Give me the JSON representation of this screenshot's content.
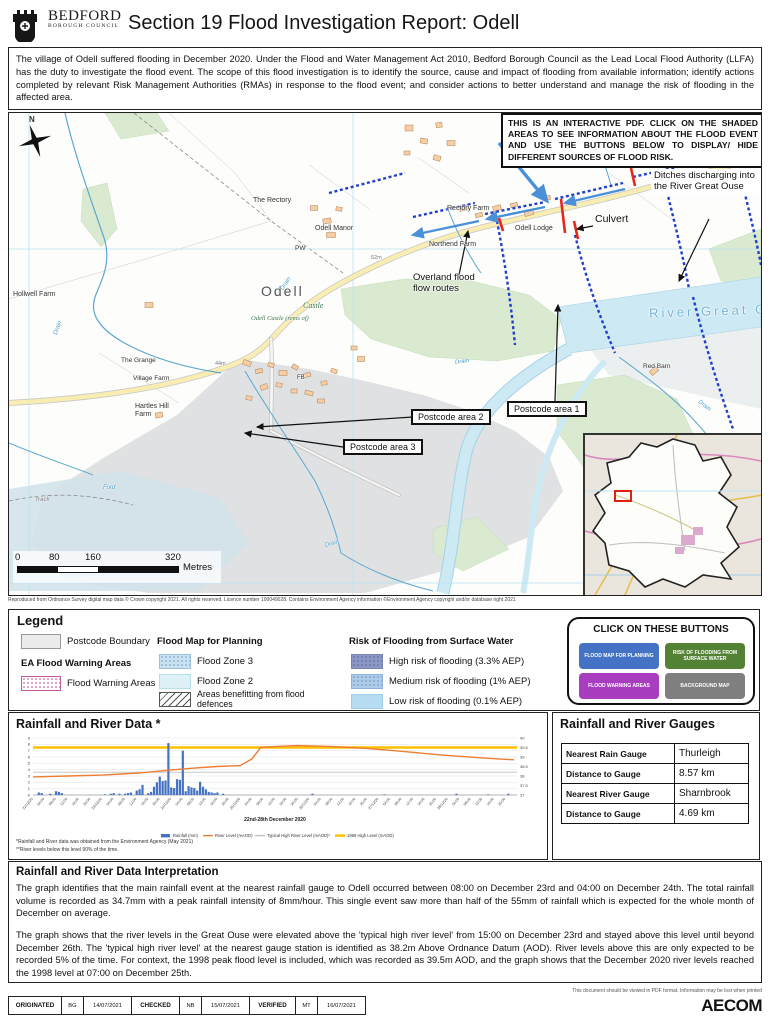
{
  "header": {
    "council_name": "BEDFORD",
    "council_sub": "BOROUGH COUNCIL",
    "title": "Section 19 Flood Investigation Report: Odell"
  },
  "intro": {
    "text": "The village of Odell suffered flooding in December 2020. Under the Flood and Water Management Act 2010, Bedford Borough Council as the Lead Local Flood Authority (LLFA) has the duty to investigate the flood event. The scope of this flood investigation is to identify the source, cause and impact of flooding from available information; identify actions completed by relevant Risk Management Authorities (RMAs) in response to the flood event; and consider actions to better understand and manage the risk of flooding in the affected area."
  },
  "map": {
    "notice": "THIS IS AN INTERACTIVE PDF. CLICK ON THE SHADED AREAS TO SEE INFORMATION ABOUT THE FLOOD EVENT AND USE THE BUTTONS BELOW TO DISPLAY/ HIDE DIFFERENT SOURCES OF FLOOD RISK.",
    "annotations": {
      "ditches": "Ditches discharging into the River Great Ouse",
      "culvert": "Culvert",
      "overland": "Overland flood flow routes",
      "postcode1": "Postcode area 1",
      "postcode2": "Postcode area 2",
      "postcode3": "Postcode area 3"
    },
    "labels": {
      "north": "N",
      "odell": "Odell",
      "river": "River Great Ouse",
      "rectory_farm": "Rectory Farm",
      "northend_farm": "Northend Farm",
      "odell_lodge": "Odell Lodge",
      "the_rectory": "The Rectory",
      "odell_manor": "Odell Manor",
      "pw": "PW",
      "castle": "Castle",
      "odell_castle": "Odell Castle (rems of)",
      "hollwell_farm": "Hollwell Farm",
      "hartles_hill_farm": "Hartles Hill Farm",
      "the_grange": "The Grange",
      "village_farm": "Village Farm",
      "red_barn": "Red Barn",
      "drain": "Drain",
      "track": "Track",
      "ford": "Ford",
      "fb": "FB",
      "spot_52": "52m",
      "spot_49": "49m",
      "spot_44": "44m"
    },
    "scalebar": {
      "ticks": [
        "0",
        "80",
        "160",
        "320"
      ],
      "unit": "Metres"
    },
    "attribution": "Reproduced from Ordnance Survey digital map data © Crown copyright 2021. All rights reserved. Licence number 100049028. Contains Environment Agency information ©Environment Agency copyright and/or database right 2021"
  },
  "legend": {
    "title": "Legend",
    "postcode_boundary": "Postcode Boundary",
    "ea_heading": "EA Flood Warning Areas",
    "flood_warning": "Flood Warning Areas",
    "planning_heading": "Flood Map for Planning",
    "zone3": "Flood Zone 3",
    "zone2": "Flood Zone 2",
    "defences": "Areas benefitting from flood defences",
    "surface_heading": "Risk of Flooding from Surface Water",
    "high": "High risk of flooding (3.3% AEP)",
    "medium": "Medium risk of flooding (1% AEP)",
    "low": "Low risk of flooding (0.1% AEP)",
    "buttons": {
      "title": "CLICK ON THESE BUTTONS",
      "items": [
        {
          "label": "FLOOD MAP FOR PLANNING",
          "color": "#4472C4"
        },
        {
          "label": "RISK OF FLOODING FROM SURFACE WATER",
          "color": "#548235"
        },
        {
          "label": "FLOOD WARNING AREAS",
          "color": "#A83DC0"
        },
        {
          "label": "BACKGROUND MAP",
          "color": "#7F7F7F"
        }
      ]
    }
  },
  "rainfall_panel": {
    "title": "Rainfall and River Data *",
    "footnote1": "*Rainfall and River data was obtained from the Environment Agency (May 2021)",
    "footnote2": "**River levels below this level 90% of the time."
  },
  "gauges": {
    "title": "Rainfall and River Gauges",
    "rows": [
      {
        "label": "Nearest Rain Gauge",
        "value": "Thurleigh"
      },
      {
        "label": "Distance to Gauge",
        "value": "8.57 km"
      },
      {
        "label": "Nearest River Gauge",
        "value": "Sharnbrook"
      },
      {
        "label": "Distance to Gauge",
        "value": "4.69 km"
      }
    ]
  },
  "interpretation": {
    "title": "Rainfall and River Data Interpretation",
    "para1": "The graph identifies that the main rainfall event at the nearest rainfall gauge to Odell occurred between 08:00 on December 23rd and 04:00 on December 24th. The total rainfall volume is recorded as 34.7mm with a peak rainfall intensity of 8mm/hour. This single event saw more than half of the 55mm of rainfall which is expected for the whole month of December on average.",
    "para2": "The graph shows that the river levels in the Great Ouse were elevated above the 'typical high river level' from 15:00 on December 23rd and stayed above this level until beyond December 26th. The 'typical high river level' at the nearest gauge station is identified as 38.2m Above Ordnance Datum (AOD). River levels above this are only expected to be recorded 5% of the time. For context, the 1998 peak flood level is included, which was recorded as 39.5m AOD, and the graph shows that the December 2020 river levels reached the 1998 level at 07:00 on December 25th."
  },
  "footer": {
    "note": "This document should be viewed in PDF format. Information may be lost when printed",
    "cells": [
      {
        "label": "ORIGINATED",
        "initials": "BG",
        "date": "14/07/2021"
      },
      {
        "label": "CHECKED",
        "initials": "NB",
        "date": "15/07/2021"
      },
      {
        "label": "VERIFIED",
        "initials": "MT",
        "date": "16/07/2021"
      }
    ],
    "brand": "AECOM"
  },
  "chart_data": {
    "type": "bar",
    "title": "Rainfall and River Data *",
    "x_title": "22nd-28th December 2020",
    "hours_span": 168,
    "hours_per_tick": 4,
    "x_tick_labels": [
      "22/12/20",
      "04:00",
      "08:00",
      "12:00",
      "16:00",
      "20:00",
      "23/12/20",
      "04:00",
      "08:00",
      "12:00",
      "16:00",
      "20:00",
      "24/12/20",
      "04:00",
      "08:00",
      "12:00",
      "16:00",
      "20:00",
      "25/12/20",
      "04:00",
      "08:00",
      "12:00",
      "16:00",
      "20:00",
      "26/12/20",
      "04:00",
      "08:00",
      "12:00",
      "16:00",
      "20:00",
      "27/12/20",
      "04:00",
      "08:00",
      "12:00",
      "16:00",
      "20:00",
      "28/12/20",
      "04:00",
      "08:00",
      "12:00",
      "16:00",
      "20:00"
    ],
    "left_axis": {
      "label": "Rainfall (mm)",
      "min": 0,
      "max": 9,
      "step": 1
    },
    "right_axis": {
      "label": "River Level (mAOD)",
      "min": 37,
      "max": 40,
      "step": 0.5
    },
    "rainfall": {
      "name": "Rainfall (mm)",
      "color": "#4472C4",
      "points": [
        [
          2,
          0.4
        ],
        [
          3,
          0.3
        ],
        [
          6,
          0.2
        ],
        [
          8,
          0.6
        ],
        [
          9,
          0.5
        ],
        [
          10,
          0.3
        ],
        [
          25,
          0.1
        ],
        [
          27,
          0.2
        ],
        [
          28,
          0.3
        ],
        [
          30,
          0.2
        ],
        [
          32,
          0.2
        ],
        [
          33,
          0.3
        ],
        [
          34,
          0.4
        ],
        [
          36,
          0.7
        ],
        [
          37,
          0.9
        ],
        [
          38,
          1.6
        ],
        [
          40,
          0.3
        ],
        [
          41,
          0.5
        ],
        [
          42,
          1.3
        ],
        [
          43,
          2.0
        ],
        [
          44,
          2.9
        ],
        [
          45,
          2.2
        ],
        [
          46,
          2.3
        ],
        [
          47,
          8.2
        ],
        [
          48,
          1.2
        ],
        [
          49,
          1.1
        ],
        [
          50,
          2.5
        ],
        [
          51,
          2.4
        ],
        [
          52,
          7.0
        ],
        [
          53,
          0.6
        ],
        [
          54,
          1.4
        ],
        [
          55,
          1.2
        ],
        [
          56,
          1.1
        ],
        [
          57,
          0.7
        ],
        [
          58,
          2.1
        ],
        [
          59,
          1.3
        ],
        [
          60,
          0.9
        ],
        [
          61,
          0.5
        ],
        [
          62,
          0.4
        ],
        [
          63,
          0.3
        ],
        [
          64,
          0.4
        ],
        [
          66,
          0.2
        ],
        [
          97,
          0.2
        ],
        [
          122,
          0.1
        ],
        [
          147,
          0.2
        ],
        [
          158,
          0.1
        ],
        [
          165,
          0.2
        ]
      ]
    },
    "river": {
      "name": "River Level (mAOD)",
      "color": "#ED7D31",
      "points": [
        [
          0,
          37.95
        ],
        [
          12,
          38.0
        ],
        [
          24,
          38.05
        ],
        [
          36,
          38.15
        ],
        [
          40,
          38.2
        ],
        [
          48,
          38.32
        ],
        [
          56,
          38.42
        ],
        [
          64,
          38.5
        ],
        [
          72,
          38.55
        ],
        [
          76,
          38.9
        ],
        [
          79,
          39.5
        ],
        [
          84,
          39.55
        ],
        [
          92,
          39.6
        ],
        [
          104,
          39.55
        ],
        [
          116,
          39.45
        ],
        [
          128,
          39.3
        ],
        [
          142,
          39.1
        ],
        [
          156,
          38.95
        ],
        [
          167,
          38.85
        ]
      ]
    },
    "typical_high": {
      "name": "Typical High River Level (mAOD)*",
      "color": "#BFBFBF",
      "value": 38.2
    },
    "high_1998": {
      "name": "1998 High Level (mAOD)",
      "color": "#FFC000",
      "value": 39.5
    }
  }
}
